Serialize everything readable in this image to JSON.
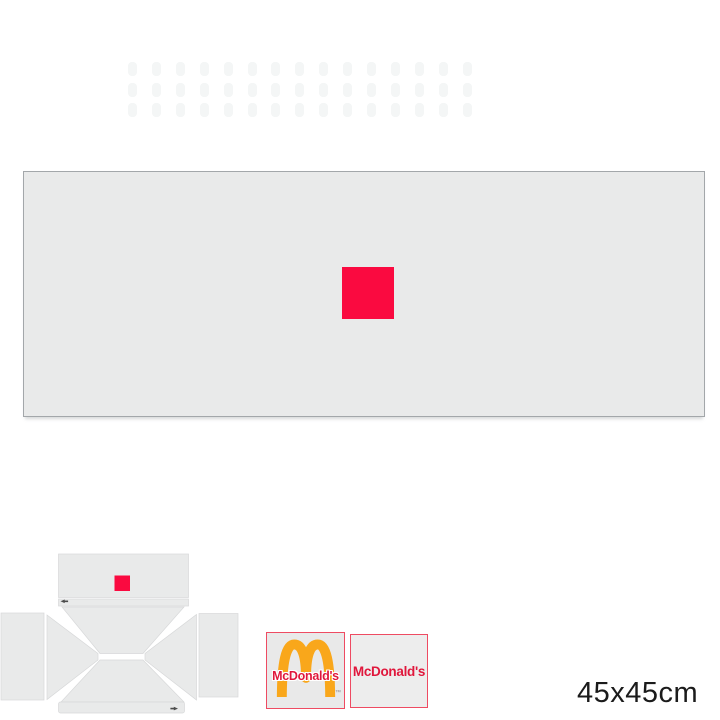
{
  "meta": {
    "size_label": "45x45cm"
  },
  "colors": {
    "page_bg": "#ffffff",
    "panel_gray": "#e9eaea",
    "panel_border": "#a3a7aa",
    "diagram_gray": "#e9eaea",
    "print_red": "#fa0a40",
    "swatch_border": "#ee4b62",
    "arches_gold": "#f9a71b",
    "brand_red": "#e0173c",
    "mark_dark": "#4c4c4c",
    "watermark": "#f4f6f6",
    "label_color": "#1b1b1b"
  },
  "swatches": {
    "arches": {
      "text": "McDonald's",
      "trademark": "™"
    },
    "wordmark": {
      "text": "McDonald's"
    }
  },
  "decor_grid": {
    "cols": 15,
    "rows": 3,
    "x": 128,
    "y": 62,
    "dx": 23.9,
    "dy": 20.5,
    "w": 9,
    "h": 14
  }
}
